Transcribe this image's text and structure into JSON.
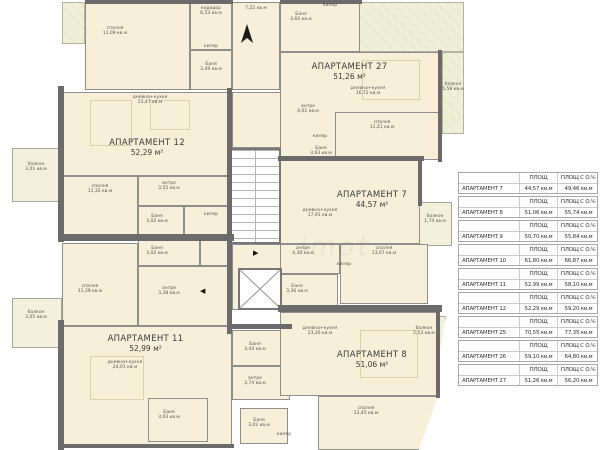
{
  "plan": {
    "watermark": "imot",
    "apartments": [
      {
        "name": "АПАРТАМЕНТ 12",
        "area": "52,29 м²"
      },
      {
        "name": "АПАРТАМЕНТ 27",
        "area": "51,26 м²"
      },
      {
        "name": "АПАРТАМЕНТ 7",
        "area": "44,57 м²"
      },
      {
        "name": "АПАРТАМЕНТ 11",
        "area": "52,99 м²"
      },
      {
        "name": "АПАРТАМЕНТ 8",
        "area": "51,06 м²"
      }
    ],
    "rooms": [
      {
        "label": "спалня",
        "area": "11,09 кв.м"
      },
      {
        "label": "коридор",
        "area": "6,53 кв.м"
      },
      {
        "label": "килер",
        "area": ""
      },
      {
        "label": "Баня",
        "area": "3,49 кв.м"
      },
      {
        "label": "",
        "area": "7,22 кв.м"
      },
      {
        "label": "Баня",
        "area": "3,60 кв.м"
      },
      {
        "label": "килер",
        "area": ""
      },
      {
        "label": "дневна+кухня",
        "area": "23,47 кв.м"
      },
      {
        "label": "спалня",
        "area": "11,35 кв.м"
      },
      {
        "label": "антре",
        "area": "3,55 кв.м"
      },
      {
        "label": "балкон",
        "area": "3,01 кв.м"
      },
      {
        "label": "килер",
        "area": ""
      },
      {
        "label": "Баня",
        "area": "3,02 кв.м"
      },
      {
        "label": "Баня",
        "area": "3,02 кв.м"
      },
      {
        "label": "спалня",
        "area": "11,39 кв.м"
      },
      {
        "label": "антре",
        "area": "3,38 кв.м"
      },
      {
        "label": "балкон",
        "area": "3,05 кв.м"
      },
      {
        "label": "дневна+кухня",
        "area": "24,01 кв.м"
      },
      {
        "label": "Баня",
        "area": "3,03 кв.м"
      },
      {
        "label": "дневна+кухня",
        "area": "16,72 кв.м"
      },
      {
        "label": "антре",
        "area": "4,01 кв.м"
      },
      {
        "label": "спалня",
        "area": "11,21 кв.м"
      },
      {
        "label": "килер",
        "area": ""
      },
      {
        "label": "Баня",
        "area": "3,63 кв.м"
      },
      {
        "label": "балкон",
        "area": "5,58 кв.м"
      },
      {
        "label": "дневна+кухня",
        "area": "17,91 кв.м"
      },
      {
        "label": "антре",
        "area": "4,30 кв.м"
      },
      {
        "label": "килер",
        "area": ""
      },
      {
        "label": "Баня",
        "area": "3,36 кв.м"
      },
      {
        "label": "спалня",
        "area": "13,07 кв.м"
      },
      {
        "label": "балкон",
        "area": "1,74 кв.м"
      },
      {
        "label": "дневна+кухня",
        "area": "23,26 кв.м"
      },
      {
        "label": "балкон",
        "area": "2,53 кв.м"
      },
      {
        "label": "Баня",
        "area": "3,44 кв.м"
      },
      {
        "label": "антре",
        "area": "3,74 кв.м"
      },
      {
        "label": "Баня",
        "area": "3,02 кв.м"
      },
      {
        "label": "килер",
        "area": ""
      },
      {
        "label": "спалня",
        "area": "13,45 кв.м"
      }
    ]
  },
  "table": {
    "col_area": "ПЛОЩ",
    "col_area_common": "ПЛОЩ С О.Ч.",
    "rows": [
      {
        "name": "АПАРТАМЕНТ 7",
        "area": "44,57 кв.м",
        "area_common": "49,46 кв.м"
      },
      {
        "name": "АПАРТАМЕНТ 8",
        "area": "51,06 кв.м",
        "area_common": "55,74 кв.м"
      },
      {
        "name": "АПАРТАМЕНТ 9",
        "area": "50,70 кв.м",
        "area_common": "55,84 кв.м"
      },
      {
        "name": "АПАРТАМЕНТ 10",
        "area": "61,80 кв.м",
        "area_common": "66,87 кв.м"
      },
      {
        "name": "АПАРТАМЕНТ 11",
        "area": "52,99 кв.м",
        "area_common": "58,10 кв.м"
      },
      {
        "name": "АПАРТАМЕНТ 12",
        "area": "52,29 кв.м",
        "area_common": "59,20 кв.м"
      },
      {
        "name": "АПАРТАМЕНТ 25",
        "area": "70,55 кв.м",
        "area_common": "77,35 кв.м"
      },
      {
        "name": "АПАРТАМЕНТ 26",
        "area": "59,10 кв.м",
        "area_common": "64,80 кв.м"
      },
      {
        "name": "АПАРТАМЕНТ 27",
        "area": "51,26 кв.м",
        "area_common": "56,20 кв.м"
      }
    ]
  }
}
